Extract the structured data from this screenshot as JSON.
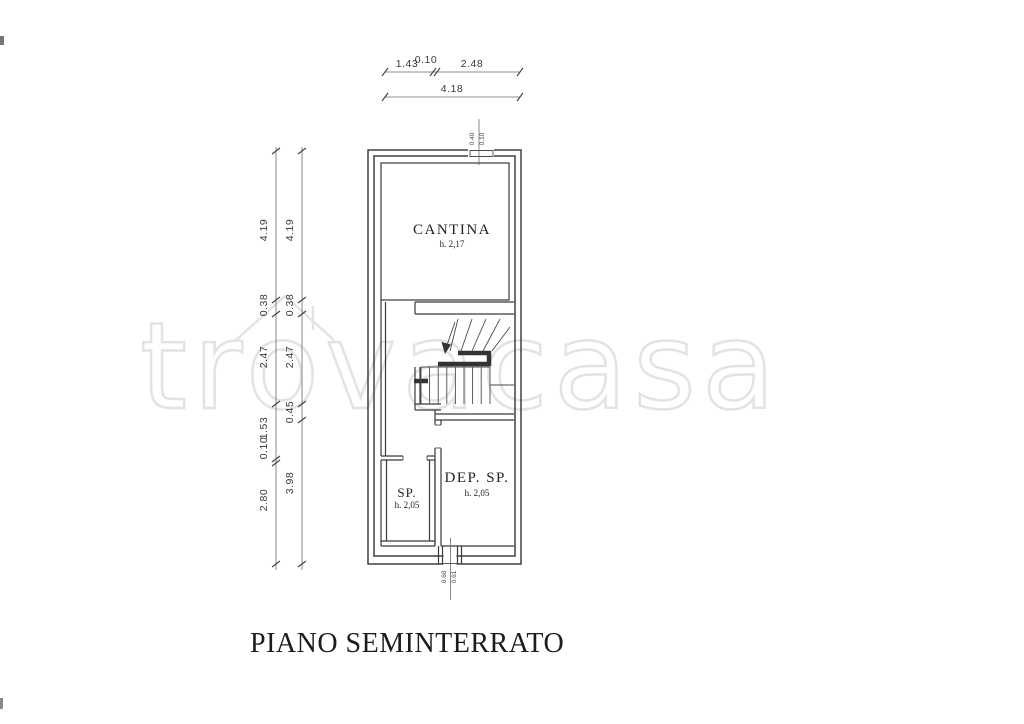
{
  "document": {
    "title": "PIANO SEMINTERRATO",
    "watermark": {
      "full": "trovacasa"
    }
  },
  "rooms": {
    "cantina": {
      "name": "CANTINA",
      "height": "h. 2,17"
    },
    "sp": {
      "name": "SP.",
      "height": "h. 2,05"
    },
    "dep_sp": {
      "name": "DEP. SP.",
      "height": "h. 2,05"
    }
  },
  "dimensions": {
    "top_segments": [
      "1.43",
      "0.10",
      "2.48"
    ],
    "top_total": "4.18",
    "left_outer": [
      "4.19",
      "0.38",
      "2.47",
      "1.53",
      "0.10",
      "2.80"
    ],
    "left_inner": [
      "4.19",
      "0.38",
      "2.47",
      "0.45",
      "3.98"
    ],
    "top_opening": [
      "0.40",
      "0.10"
    ],
    "bottom_opening": [
      "0.60",
      "0.61"
    ]
  }
}
